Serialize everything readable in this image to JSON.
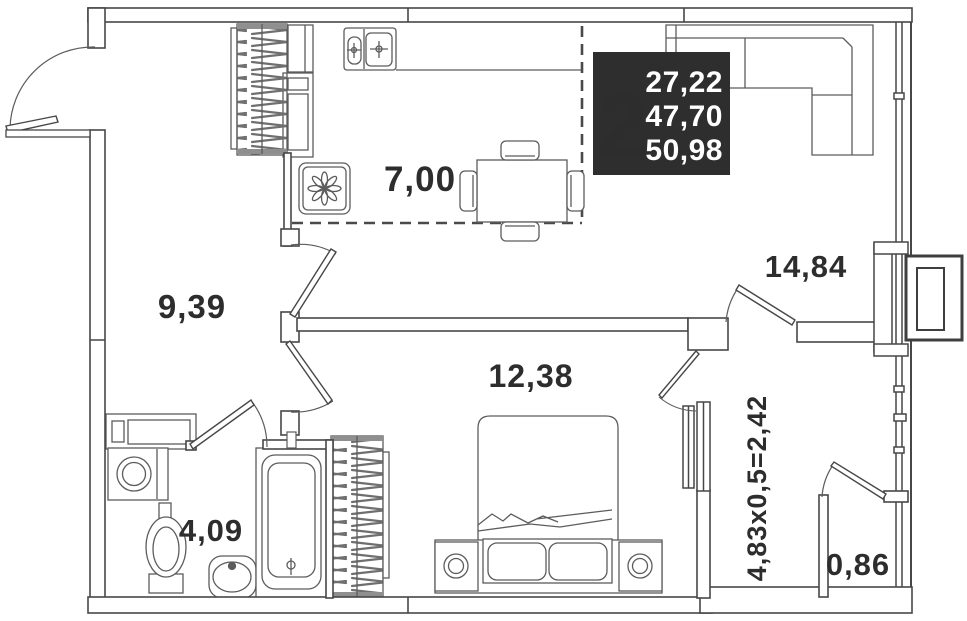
{
  "plan": {
    "type": "apartment-floor-plan",
    "badge": {
      "rooms_count": "2",
      "asterisk": "*",
      "area_line1": "27,22",
      "area_line2": "47,70",
      "area_line3": "50,98"
    },
    "labels": {
      "kitchen": "7,00",
      "hallway": "9,39",
      "living_room": "14,84",
      "bedroom": "12,38",
      "bathroom": "4,09",
      "loggia_formula": "4,83x0,5=2,42",
      "balcony": "0,86"
    },
    "colors": {
      "background": "#ffffff",
      "wall_line": "#474747",
      "furniture_line": "#5c5c5c",
      "label_text": "#2d2d2d",
      "badge_bg": "#2e2e2e",
      "badge_text": "#ffffff"
    }
  }
}
